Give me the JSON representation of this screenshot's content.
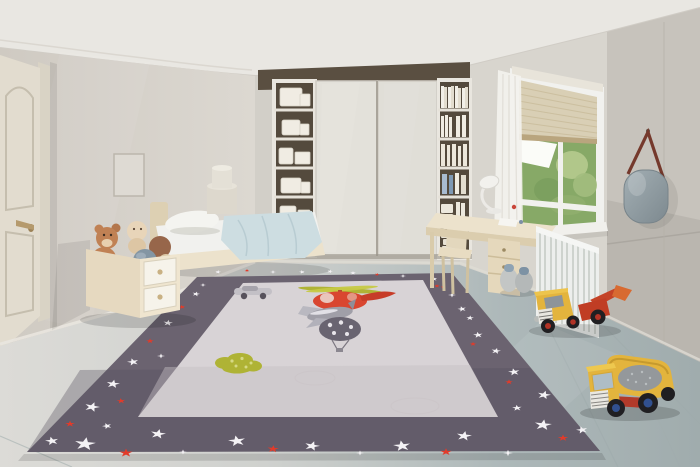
{
  "scene": {
    "objects": [
      "door",
      "picture-frame",
      "bed",
      "pillow",
      "blanket",
      "nightstand",
      "toy-box",
      "teddy-bears",
      "wardrobe",
      "shelf-tower-left",
      "shelf-tower-right",
      "window",
      "blind",
      "curtain",
      "desk",
      "chair",
      "desk-lamp",
      "radiator",
      "mirror",
      "play-rug",
      "rug-stars",
      "helicopter-motif",
      "plane-motif",
      "balloon-motif",
      "car-motif",
      "green-blob-motif",
      "toy-loader-truck",
      "toy-dump-truck",
      "pebble-toys"
    ],
    "colors": {
      "ceiling": "#e9e7e2",
      "wallLeft": "#d7d3cc",
      "wallBack": "#d2cfc8",
      "wallWindow": "#d8d5ce",
      "wallRight": "#c7c3bc",
      "door": "#e2dccf",
      "doorFrame": "#d9d3c5",
      "rugBorder": "#6b6370",
      "rugField": "#d8d3d6",
      "starWhite": "#f4f2f5",
      "starRed": "#e23b2a",
      "wood": "#ddd0b3",
      "woodLight": "#ece2cc",
      "white": "#f1f1ee",
      "bedding": "#cddde1",
      "pillow": "#f4f4f0",
      "wardrobe": "#e3e1da",
      "shelfBack": "#544a3d",
      "glassGreen": "#87a967",
      "glassLight": "#b6ca8e",
      "sky": "#fbfcf8",
      "blind": "#d9cfb5",
      "radiator": "#edefed",
      "mirror": "#95a1a7",
      "mirrorStrap": "#75392c",
      "heliRed": "#d94630",
      "planeGray": "#a09fa8",
      "balloonGray": "#696471",
      "olive": "#afb335",
      "truckYellow": "#e3b43d",
      "truckRed": "#c44327",
      "wheel": "#201f22",
      "hubRed": "#b23326",
      "hubBlue": "#31508f",
      "load": "#94989b",
      "bearTan": "#c08154",
      "bearCream": "#e8d5b9",
      "ballBlue": "#8496a3",
      "ballBrown": "#97664a",
      "curtain": "#f3f2ee",
      "sill": "#f1f0ec"
    },
    "stars": [
      {
        "x": 218,
        "y": 272,
        "s": 3,
        "c": "w",
        "t": "star",
        "r": 10
      },
      {
        "x": 247,
        "y": 270.5,
        "s": 2.5,
        "c": "r",
        "t": "star",
        "r": 0
      },
      {
        "x": 273,
        "y": 272,
        "s": 3,
        "c": "w",
        "t": "sparkle",
        "r": 0
      },
      {
        "x": 302,
        "y": 272,
        "s": 3,
        "c": "w",
        "t": "star",
        "r": -12
      },
      {
        "x": 330,
        "y": 271.5,
        "s": 3,
        "c": "w",
        "t": "star",
        "r": 20
      },
      {
        "x": 353,
        "y": 273,
        "s": 3,
        "c": "w",
        "t": "star",
        "r": 0
      },
      {
        "x": 377,
        "y": 274.5,
        "s": 2.5,
        "c": "r",
        "t": "star",
        "r": 14
      },
      {
        "x": 403,
        "y": 276,
        "s": 3,
        "c": "w",
        "t": "sparkle",
        "r": 0
      },
      {
        "x": 434,
        "y": 279,
        "s": 3.5,
        "c": "w",
        "t": "star",
        "r": -8
      },
      {
        "x": 443,
        "y": 287,
        "s": 2.5,
        "c": "r",
        "t": "star",
        "r": 0
      },
      {
        "x": 203,
        "y": 285,
        "s": 3,
        "c": "w",
        "t": "sparkle",
        "r": 0
      },
      {
        "x": 196,
        "y": 294,
        "s": 4,
        "c": "w",
        "t": "star",
        "r": 15
      },
      {
        "x": 182,
        "y": 307,
        "s": 3.5,
        "c": "r",
        "t": "star",
        "r": -10
      },
      {
        "x": 168,
        "y": 323,
        "s": 5,
        "c": "w",
        "t": "star",
        "r": 8
      },
      {
        "x": 150,
        "y": 341,
        "s": 4,
        "c": "r",
        "t": "star",
        "r": 0
      },
      {
        "x": 161,
        "y": 356,
        "s": 4,
        "c": "w",
        "t": "sparkle",
        "r": 0
      },
      {
        "x": 133,
        "y": 362,
        "s": 6,
        "c": "w",
        "t": "star",
        "r": -14
      },
      {
        "x": 113,
        "y": 384,
        "s": 7,
        "c": "w",
        "t": "star",
        "r": 10
      },
      {
        "x": 121,
        "y": 401,
        "s": 4.5,
        "c": "r",
        "t": "star",
        "r": -6
      },
      {
        "x": 92,
        "y": 407,
        "s": 8,
        "c": "w",
        "t": "star",
        "r": 18
      },
      {
        "x": 70,
        "y": 424,
        "s": 5,
        "c": "r",
        "t": "star",
        "r": 0
      },
      {
        "x": 52,
        "y": 441,
        "s": 7,
        "c": "w",
        "t": "star",
        "r": -12
      },
      {
        "x": 85,
        "y": 444,
        "s": 11,
        "c": "w",
        "t": "star",
        "r": 8
      },
      {
        "x": 107,
        "y": 426,
        "s": 5,
        "c": "w",
        "t": "star",
        "r": -20
      },
      {
        "x": 126,
        "y": 453,
        "s": 7,
        "c": "r",
        "t": "star",
        "r": 0
      },
      {
        "x": 158,
        "y": 434,
        "s": 8,
        "c": "w",
        "t": "star",
        "r": 12
      },
      {
        "x": 183,
        "y": 452,
        "s": 4,
        "c": "w",
        "t": "sparkle",
        "r": 0
      },
      {
        "x": 237,
        "y": 441,
        "s": 9,
        "c": "w",
        "t": "star",
        "r": -10
      },
      {
        "x": 273,
        "y": 449,
        "s": 6,
        "c": "r",
        "t": "star",
        "r": 6
      },
      {
        "x": 312,
        "y": 446,
        "s": 8,
        "c": "w",
        "t": "star",
        "r": 16
      },
      {
        "x": 360,
        "y": 453,
        "s": 4,
        "c": "w",
        "t": "sparkle",
        "r": 0
      },
      {
        "x": 402,
        "y": 446,
        "s": 9,
        "c": "w",
        "t": "star",
        "r": -8
      },
      {
        "x": 446,
        "y": 452,
        "s": 6,
        "c": "r",
        "t": "star",
        "r": 0
      },
      {
        "x": 464,
        "y": 436,
        "s": 8,
        "c": "w",
        "t": "star",
        "r": 10
      },
      {
        "x": 508,
        "y": 453,
        "s": 5,
        "c": "w",
        "t": "sparkle",
        "r": 0
      },
      {
        "x": 437,
        "y": 286,
        "s": 3,
        "c": "r",
        "t": "star",
        "r": 0
      },
      {
        "x": 452,
        "y": 295,
        "s": 4,
        "c": "w",
        "t": "sparkle",
        "r": 0
      },
      {
        "x": 462,
        "y": 309,
        "s": 4.5,
        "c": "w",
        "t": "star",
        "r": -15
      },
      {
        "x": 470,
        "y": 318,
        "s": 4,
        "c": "w",
        "t": "star",
        "r": 5
      },
      {
        "x": 478,
        "y": 335,
        "s": 5,
        "c": "w",
        "t": "star",
        "r": -8
      },
      {
        "x": 473,
        "y": 344,
        "s": 3.5,
        "c": "r",
        "t": "star",
        "r": 0
      },
      {
        "x": 496,
        "y": 351,
        "s": 5,
        "c": "w",
        "t": "star",
        "r": 12
      },
      {
        "x": 514,
        "y": 372,
        "s": 6,
        "c": "w",
        "t": "star",
        "r": -10
      },
      {
        "x": 509,
        "y": 382,
        "s": 4,
        "c": "r",
        "t": "star",
        "r": 0
      },
      {
        "x": 544,
        "y": 395,
        "s": 7,
        "c": "w",
        "t": "star",
        "r": 14
      },
      {
        "x": 517,
        "y": 408,
        "s": 5,
        "c": "w",
        "t": "star",
        "r": -5
      },
      {
        "x": 543,
        "y": 425,
        "s": 9,
        "c": "w",
        "t": "star",
        "r": 8
      },
      {
        "x": 563,
        "y": 438,
        "s": 5.5,
        "c": "r",
        "t": "star",
        "r": 0
      },
      {
        "x": 582,
        "y": 430,
        "s": 6,
        "c": "w",
        "t": "star",
        "r": -14
      }
    ]
  }
}
